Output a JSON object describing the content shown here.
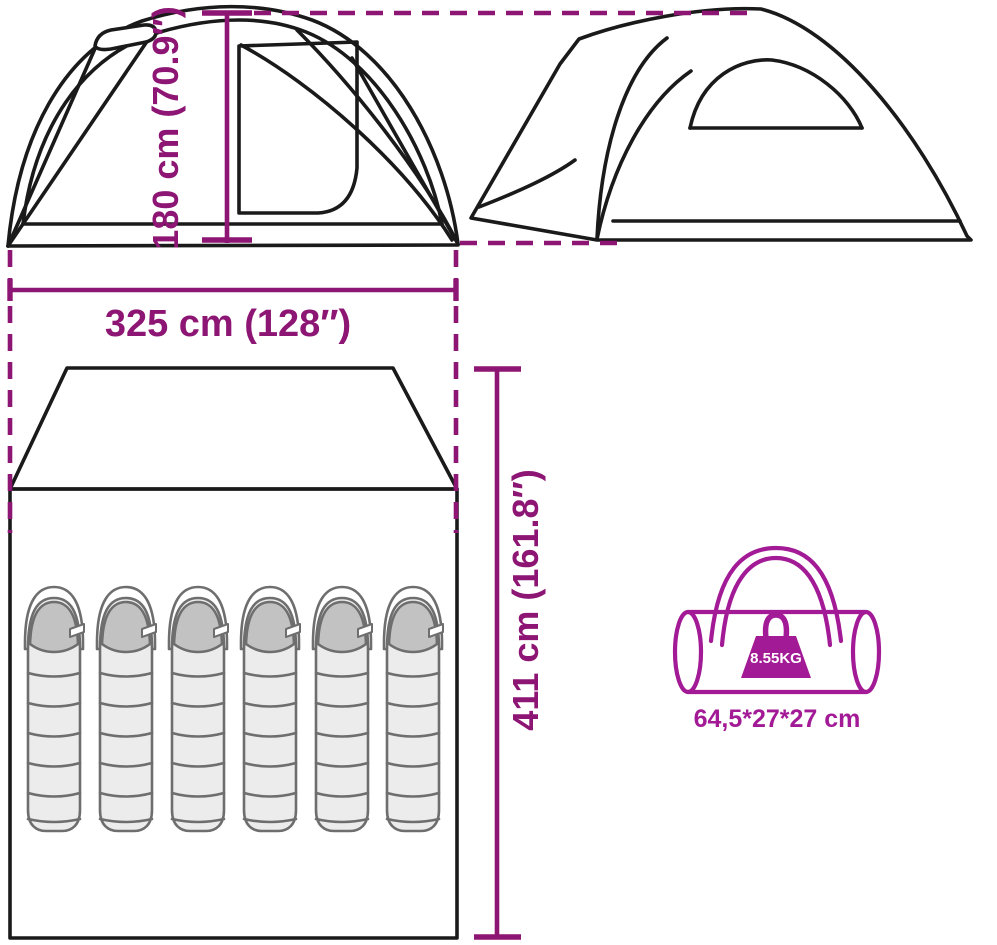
{
  "title": "Tent dimensions diagram",
  "diagram": {
    "front_view": {
      "name": "tent front elevation"
    },
    "side_view": {
      "name": "tent side elevation"
    },
    "floor_plan": {
      "name": "tent floor plan",
      "sleeping_bag_count": 6
    },
    "carry_bag_view": {
      "name": "carry bag with weight"
    }
  },
  "dimensions": {
    "height": "180 cm (70.9″)",
    "width": "325 cm (128″)",
    "length": "411 cm (161.8″)",
    "carry_bag_size": "64,5*27*27 cm",
    "carry_bag_weight": "8.55KG"
  },
  "icons": {
    "weight": "weight-icon",
    "sleeping_bag": "sleeping-bag-icon",
    "carry_bag": "duffel-bag-icon"
  },
  "colors": {
    "dimension": "#8D1573",
    "carry_bag": "#A31A96",
    "line_art": "#1A1A1A",
    "background": "#FFFFFF",
    "sleeping_bag_fill": "#ECECEC",
    "sleeping_bag_hood": "#C2C2C2",
    "sleeping_bag_outline": "#6E6E6E"
  }
}
